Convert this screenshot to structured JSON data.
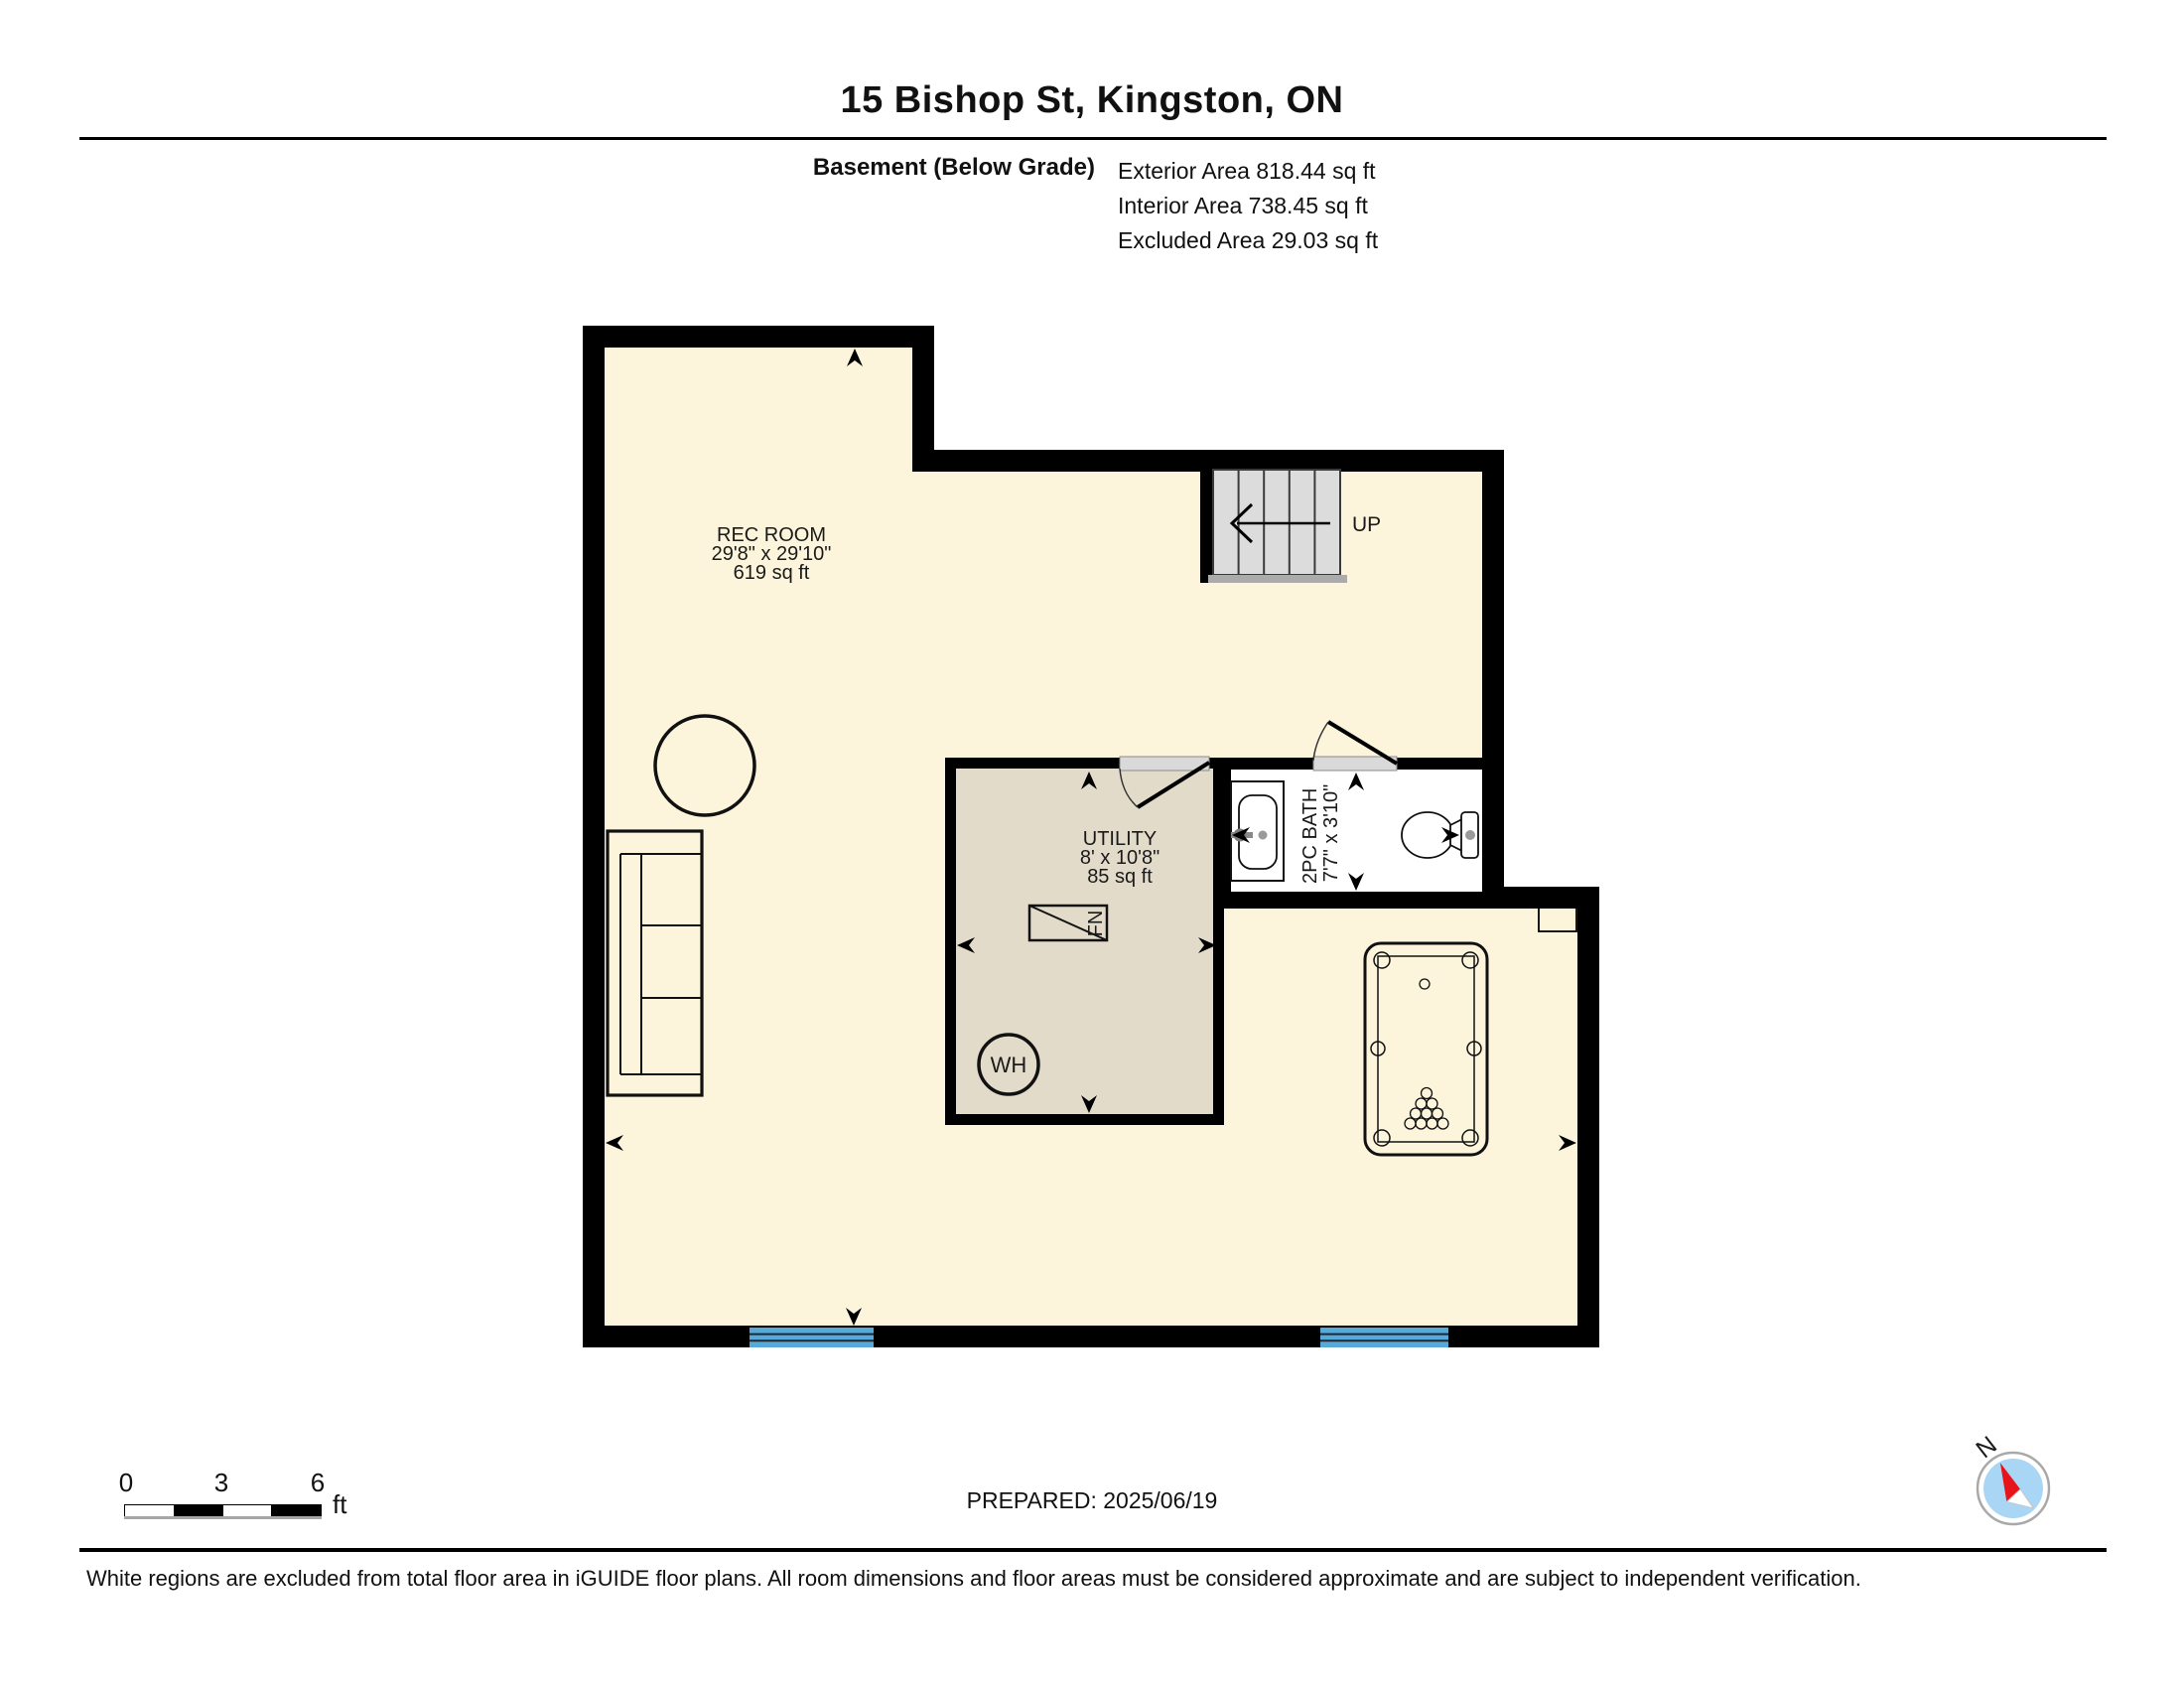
{
  "header": {
    "title": "15 Bishop St, Kingston, ON",
    "floor_label": "Basement (Below Grade)",
    "area_lines": [
      "Exterior Area 818.44 sq ft",
      "Interior Area 738.45 sq ft",
      "Excluded Area 29.03 sq ft"
    ]
  },
  "plan": {
    "rooms": {
      "rec_room": {
        "name": "REC ROOM",
        "dimensions": "29'8\" x 29'10\"",
        "area": "619 sq ft"
      },
      "utility": {
        "name": "UTILITY",
        "dimensions": "8' x 10'8\"",
        "area": "85 sq ft"
      },
      "bath": {
        "name": "2PC BATH",
        "dimensions": "7'7\" x 3'10\""
      }
    },
    "labels": {
      "stairs_up": "UP",
      "water_heater": "WH",
      "furnace": "FN"
    }
  },
  "scale_bar": {
    "tick_0": "0",
    "tick_3": "3",
    "tick_6": "6",
    "unit": "ft"
  },
  "prepared_label": "PREPARED: 2025/06/19",
  "compass": {
    "north_label": "N"
  },
  "footer": {
    "disclaimer": "White regions are excluded from total floor area in iGUIDE floor plans. All room dimensions and floor areas must be considered approximate and are subject to independent verification."
  },
  "colors": {
    "floor": "#FCF5DC",
    "utility_floor": "#E3DBCA",
    "bath_floor": "#FFFFFF",
    "wall": "#000000",
    "window": "#57A9D9",
    "stair_tread": "#DCDCDC",
    "door_sill": "#D9D9D9",
    "compass_red": "#E8141C",
    "compass_blue": "#A9D6F5"
  }
}
